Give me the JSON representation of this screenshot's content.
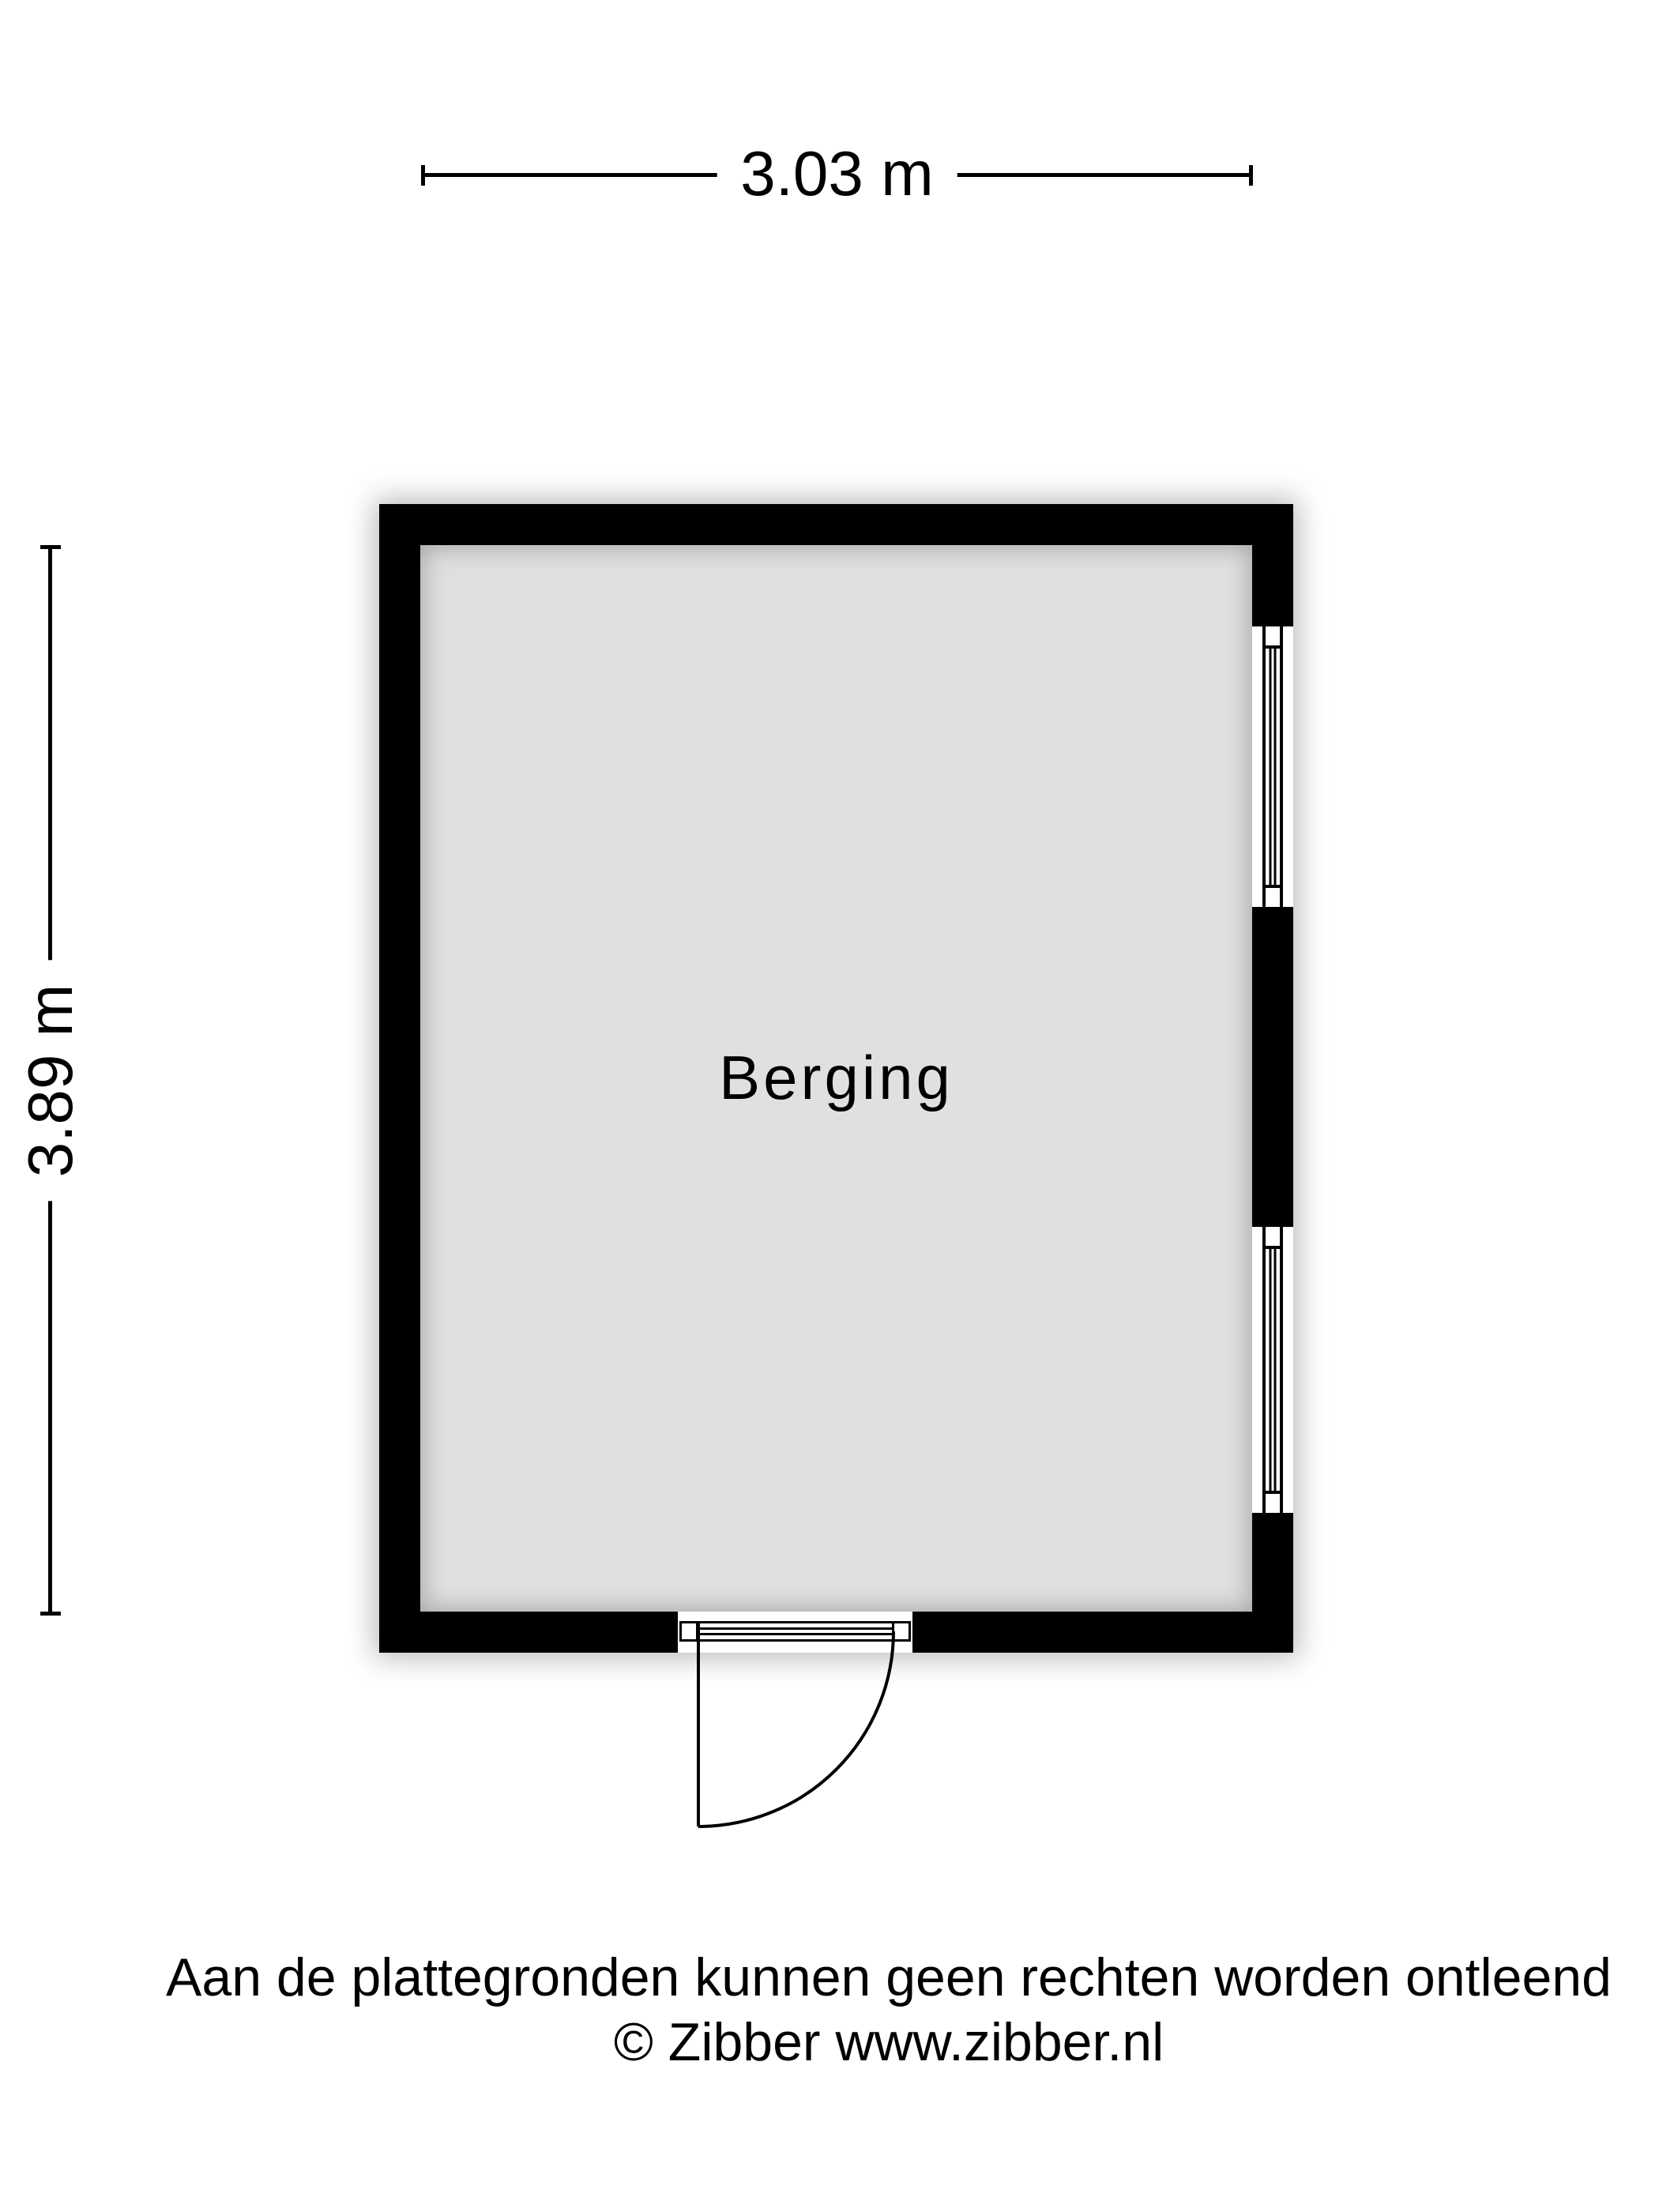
{
  "floorplan": {
    "room_label": "Berging",
    "width_dimension": "3.03 m",
    "height_dimension": "3.89 m"
  },
  "footer": {
    "disclaimer": "Aan de plattegronden kunnen geen rechten worden ontleend",
    "copyright": "© Zibber www.zibber.nl"
  },
  "colors": {
    "wall": "#000000",
    "floor": "#e0e0e0",
    "background": "#ffffff",
    "text": "#000000"
  }
}
